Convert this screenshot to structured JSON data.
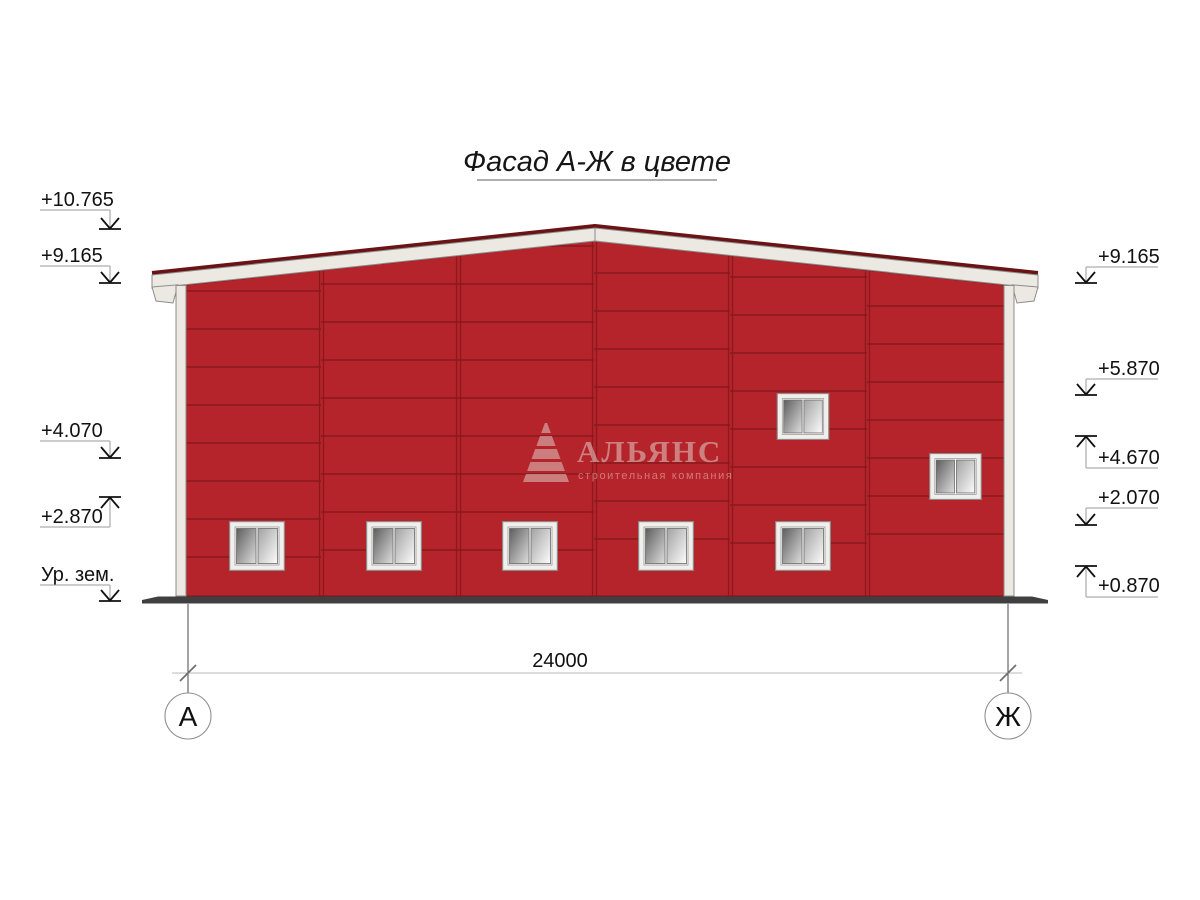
{
  "drawing": {
    "title": "Фасад А-Ж в цвете",
    "dimension_label": "24000"
  },
  "elevation_marks": {
    "left": [
      {
        "label": "+10.765",
        "type": "down"
      },
      {
        "label": "+9.165",
        "type": "down"
      },
      {
        "label": "+4.070",
        "type": "down"
      },
      {
        "label": "+2.870",
        "type": "up"
      },
      {
        "label": "Ур. зем.",
        "type": "down"
      }
    ],
    "right": [
      {
        "label": "+9.165",
        "type": "down"
      },
      {
        "label": "+5.870",
        "type": "down"
      },
      {
        "label": "+4.670",
        "type": "up"
      },
      {
        "label": "+2.070",
        "type": "down"
      },
      {
        "label": "+0.870",
        "type": "up"
      }
    ]
  },
  "axis_bubbles": [
    {
      "label": "А"
    },
    {
      "label": "Ж"
    }
  ],
  "watermark": {
    "company": "АЛЬЯНС",
    "tagline": "строительная компания"
  },
  "colors": {
    "facade_red": "#b5242a",
    "panel_joint": "#8a181c",
    "roof_cap": "#6a1214",
    "trim_white": "#ece9e3",
    "trim_stroke": "#8c8c8c",
    "ground": "#3f3f3f"
  }
}
